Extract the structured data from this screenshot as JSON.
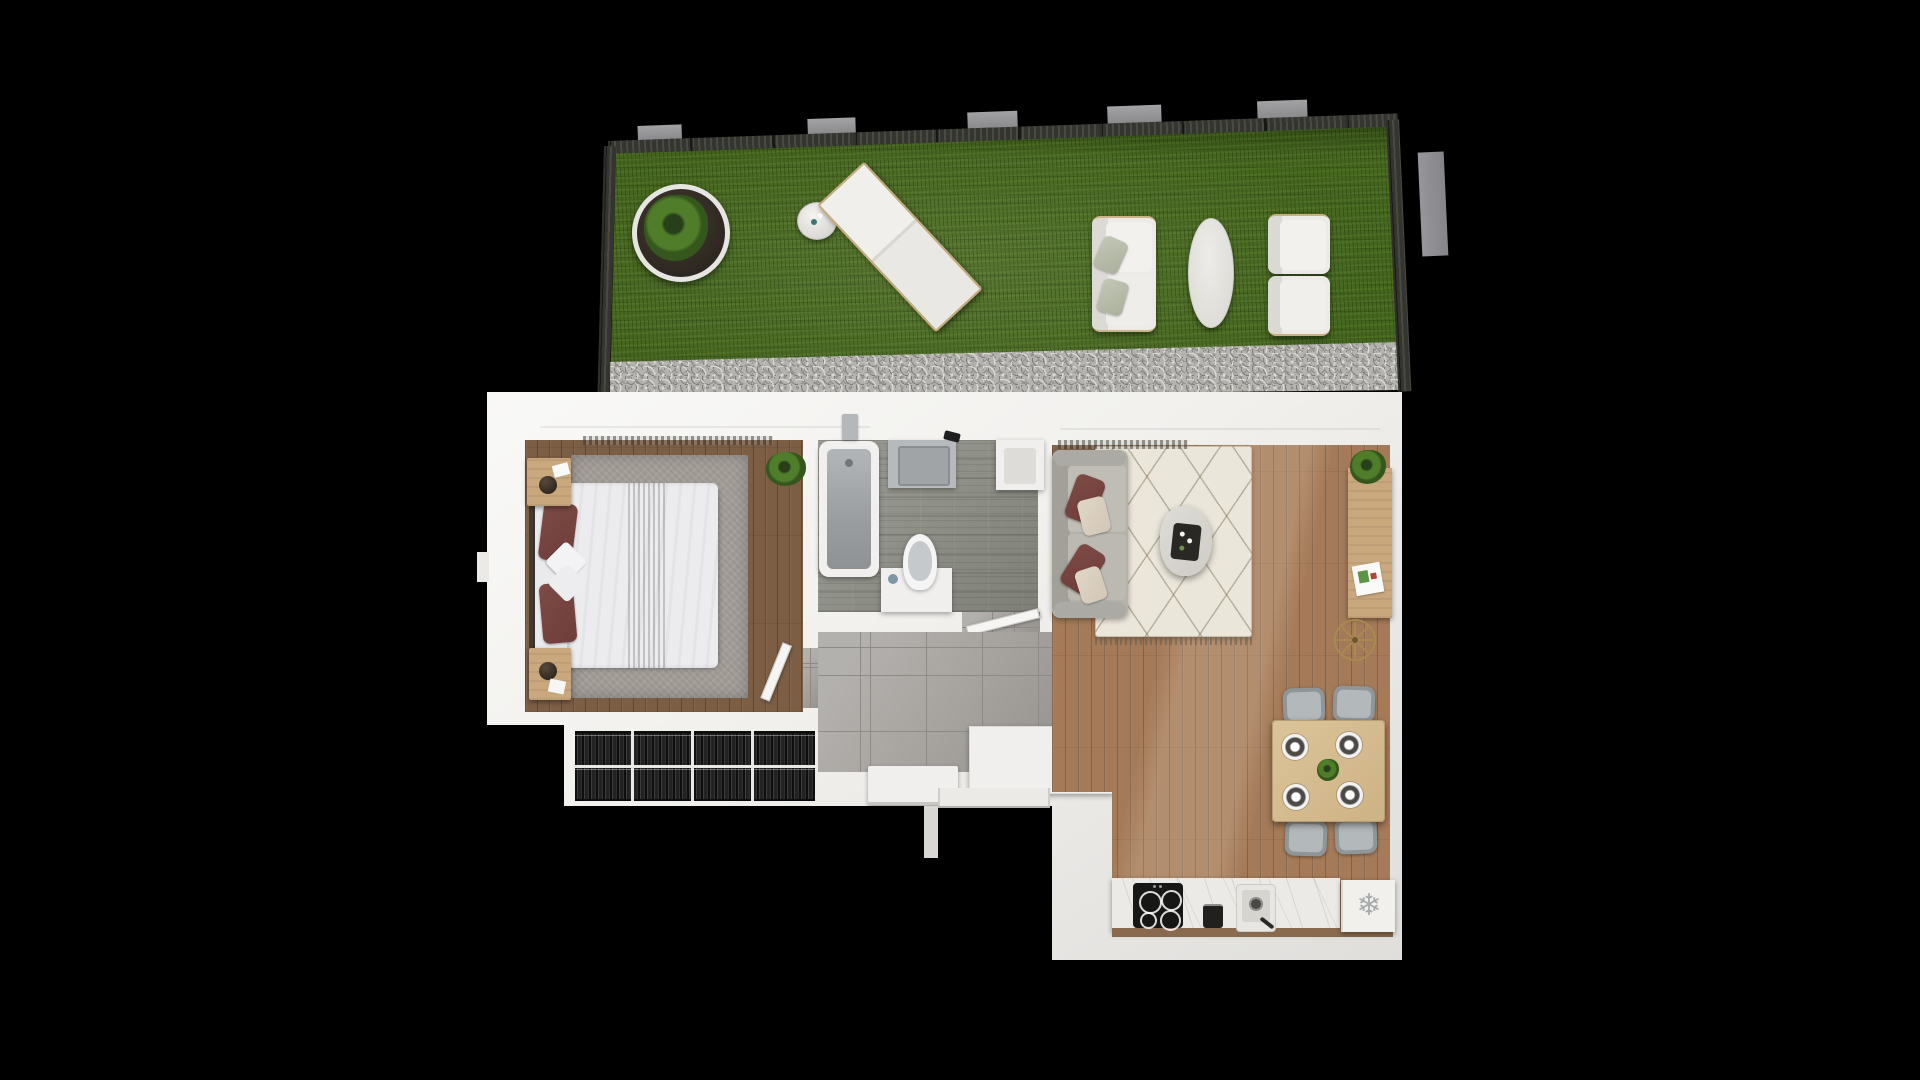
{
  "scene": {
    "type": "floor-plan-3d-top-view",
    "background_color": "#000000",
    "description": "Top-down 3D render of a one-bedroom apartment with a fenced roof-garden terrace"
  },
  "palette": {
    "scene_bg": "#000000",
    "wall": "#f2f1ee",
    "grass": "#45661e",
    "fence": "#34352f",
    "gravel": "#b5b3af",
    "wood_bedroom": "#7c5e45",
    "wood_living": "#a57a58",
    "tile_bathroom": "#8f9087",
    "tile_hall": "#a7a4a0",
    "rug_bedroom": "#a39d98",
    "rug_living": "#ebe6da",
    "bed_linen": "#eaeaed",
    "pillow_accent": "#6f3e3a",
    "sofa_grey": "#b4b1ab",
    "outdoor_white": "#ecebe7",
    "wood_accent": "#c9a87e",
    "counter_marble": "#eceae6",
    "appliance_dark": "#171716",
    "freezer_icon": "#a6aaad"
  },
  "garden": {
    "name": "roof-terrace",
    "items": [
      "potted-plant",
      "side-table",
      "sun-lounger",
      "outdoor-sofa",
      "oval-coffee-table",
      "outdoor-armchair",
      "outdoor-armchair"
    ]
  },
  "rooms": {
    "bedroom": {
      "name": "bedroom",
      "items": [
        "double-bed",
        "nightstand",
        "nightstand",
        "area-rug",
        "plant",
        "wardrobe"
      ]
    },
    "bathroom": {
      "name": "bathroom",
      "items": [
        "bathtub",
        "shower-fitting",
        "washer-unit",
        "cabinet",
        "toilet"
      ]
    },
    "hallway": {
      "name": "entrance-hall",
      "items": [
        "bench",
        "storage-cabinet",
        "front-door"
      ]
    },
    "living_room": {
      "name": "living-room",
      "items": [
        "sofa",
        "coffee-table",
        "area-rug",
        "sideboard",
        "spoke-wall-clock",
        "dining-table",
        "dining-chair",
        "dining-chair",
        "dining-chair",
        "dining-chair"
      ]
    },
    "kitchen": {
      "name": "kitchen",
      "freezer_glyph": "❄",
      "items": [
        "induction-cooktop",
        "coffee-machine",
        "sink",
        "freezer"
      ]
    }
  }
}
